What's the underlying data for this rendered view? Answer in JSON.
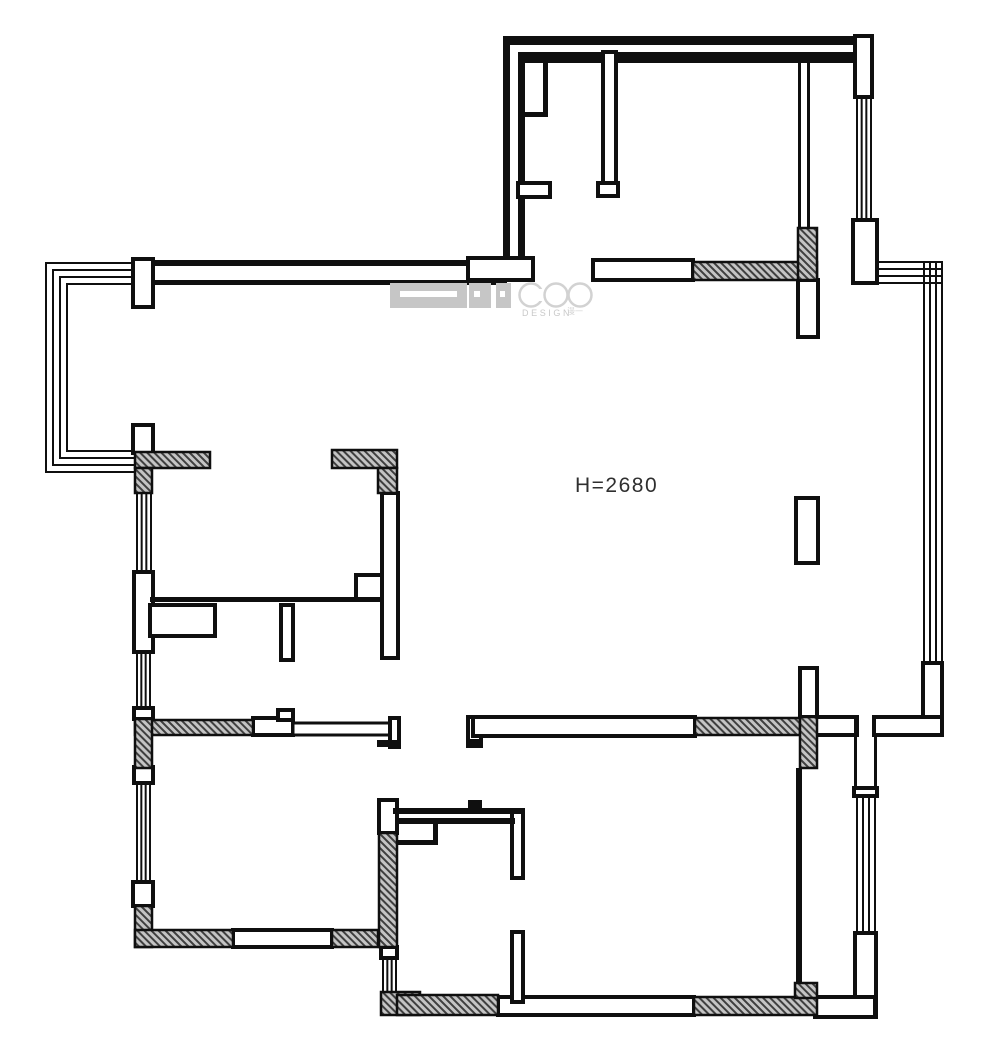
{
  "page": {
    "background": "#ffffff",
    "width": 1000,
    "height": 1056
  },
  "annotations": {
    "ceiling_height": "H=2680"
  },
  "logo": {
    "brand": "COO",
    "sub": "DESIGN",
    "seal": "漫一",
    "gray": "#c6c6c6",
    "light": "#d2d2d2"
  },
  "palette": {
    "ink": "#0f0f0f",
    "wall_fill": "#ffffff",
    "hatch_bg": "#c4c4c4",
    "hatch_line": "#3f3f3f",
    "label": "#2f2f2f"
  },
  "floorplan": {
    "width": 1000,
    "height": 1056,
    "elements": [
      {
        "t": "solid",
        "n": "top-wall-outer-line",
        "x": 135,
        "y": 260,
        "w": 372,
        "h": 6
      },
      {
        "t": "solid",
        "n": "top-wall-inner-line",
        "x": 150,
        "y": 280,
        "w": 357,
        "h": 5
      },
      {
        "t": "solid",
        "n": "north-room-top-wall",
        "x": 507,
        "y": 36,
        "w": 365,
        "h": 9
      },
      {
        "t": "solid",
        "n": "north-room-top-inner-line",
        "x": 518,
        "y": 52,
        "w": 339,
        "h": 11
      },
      {
        "t": "solid",
        "n": "north-room-left-wall-outer",
        "x": 503,
        "y": 36,
        "w": 7,
        "h": 227
      },
      {
        "t": "solid",
        "n": "north-room-left-wall-inner",
        "x": 518,
        "y": 52,
        "w": 7,
        "h": 218
      },
      {
        "t": "solid",
        "n": "duct-shaft-bottom-line",
        "x": 522,
        "y": 112,
        "w": 26,
        "h": 5
      },
      {
        "t": "solid",
        "n": "duct-shaft-right-line",
        "x": 543,
        "y": 63,
        "w": 5,
        "h": 54
      },
      {
        "t": "solid",
        "n": "north-room-divider-line-a",
        "x": 798,
        "y": 52,
        "w": 3,
        "h": 176
      },
      {
        "t": "solid",
        "n": "north-room-divider-line-b",
        "x": 807,
        "y": 52,
        "w": 3,
        "h": 176
      },
      {
        "t": "wall",
        "n": "bay-window-pier",
        "x": 133,
        "y": 259,
        "w": 20,
        "h": 48
      },
      {
        "t": "wall",
        "n": "north-room-door-jamb",
        "x": 468,
        "y": 258,
        "w": 65,
        "h": 22
      },
      {
        "t": "wall",
        "n": "north-room-closet-stub",
        "x": 518,
        "y": 183,
        "w": 32,
        "h": 14
      },
      {
        "t": "wall",
        "n": "north-room-partition",
        "x": 603,
        "y": 52,
        "w": 13,
        "h": 131
      },
      {
        "t": "wall",
        "n": "north-room-partition-foot",
        "x": 598,
        "y": 183,
        "w": 20,
        "h": 13
      },
      {
        "t": "wall",
        "n": "north-room-bottom-wall",
        "x": 593,
        "y": 260,
        "w": 100,
        "h": 20
      },
      {
        "t": "wall",
        "n": "north-room-right-wall-top",
        "x": 855,
        "y": 36,
        "w": 17,
        "h": 61
      },
      {
        "t": "wall",
        "n": "north-room-right-wall-bottom",
        "x": 853,
        "y": 220,
        "w": 24,
        "h": 63
      },
      {
        "t": "wall",
        "n": "east-wall-piece",
        "x": 923,
        "y": 663,
        "w": 19,
        "h": 72
      },
      {
        "t": "wall",
        "n": "corridor-wall-east-a",
        "x": 813,
        "y": 717,
        "w": 44,
        "h": 18
      },
      {
        "t": "wall",
        "n": "corridor-wall-east-b",
        "x": 874,
        "y": 717,
        "w": 68,
        "h": 18
      },
      {
        "t": "wall",
        "n": "balcony-door-cap",
        "x": 854,
        "y": 788,
        "w": 23,
        "h": 8
      },
      {
        "t": "wall",
        "n": "balcony-right-wall-lower",
        "x": 855,
        "y": 933,
        "w": 21,
        "h": 84
      },
      {
        "t": "wall",
        "n": "balcony-bottom-wall",
        "x": 815,
        "y": 997,
        "w": 60,
        "h": 20
      },
      {
        "t": "wall",
        "n": "living-divider-piece-1",
        "x": 798,
        "y": 280,
        "w": 20,
        "h": 57
      },
      {
        "t": "wall",
        "n": "living-divider-piece-2",
        "x": 796,
        "y": 498,
        "w": 22,
        "h": 65
      },
      {
        "t": "wall",
        "n": "living-divider-piece-3",
        "x": 800,
        "y": 668,
        "w": 17,
        "h": 49
      },
      {
        "t": "wall",
        "n": "corridor-wall-west-white",
        "x": 253,
        "y": 718,
        "w": 40,
        "h": 17
      },
      {
        "t": "wall",
        "n": "corridor-wall-west-bump",
        "x": 278,
        "y": 710,
        "w": 15,
        "h": 10
      },
      {
        "t": "wall",
        "n": "sliding-door-leaf",
        "x": 293,
        "y": 723,
        "w": 97,
        "h": 12,
        "sw": 3
      },
      {
        "t": "wall",
        "n": "west-door-jamb",
        "x": 390,
        "y": 718,
        "w": 9,
        "h": 29
      },
      {
        "t": "wall",
        "n": "east-door-jamb",
        "x": 468,
        "y": 717,
        "w": 13,
        "h": 29
      },
      {
        "t": "wall",
        "n": "corridor-wall-mid-band",
        "x": 473,
        "y": 717,
        "w": 222,
        "h": 19
      },
      {
        "t": "wall",
        "n": "bay-window-jamb-bottom",
        "x": 133,
        "y": 425,
        "w": 20,
        "h": 28
      },
      {
        "t": "wall",
        "n": "left-wall-piece",
        "x": 134,
        "y": 572,
        "w": 19,
        "h": 80
      },
      {
        "t": "wall",
        "n": "left-wall-cap-a",
        "x": 134,
        "y": 708,
        "w": 19,
        "h": 11
      },
      {
        "t": "wall",
        "n": "left-wall-cap-b",
        "x": 134,
        "y": 767,
        "w": 19,
        "h": 16
      },
      {
        "t": "wall",
        "n": "left-wall-cap-c",
        "x": 133,
        "y": 882,
        "w": 20,
        "h": 24
      },
      {
        "t": "wall",
        "n": "southwest-bottom-wall-white",
        "x": 233,
        "y": 930,
        "w": 99,
        "h": 17
      },
      {
        "t": "wall",
        "n": "bath-left-wall-top",
        "x": 379,
        "y": 800,
        "w": 18,
        "h": 33
      },
      {
        "t": "wall",
        "n": "bath-left-wall-cap",
        "x": 381,
        "y": 947,
        "w": 16,
        "h": 11
      },
      {
        "t": "wall",
        "n": "bedroom-bottom-wall-white",
        "x": 498,
        "y": 997,
        "w": 196,
        "h": 18
      },
      {
        "t": "wall",
        "n": "bath-right-wall-upper",
        "x": 512,
        "y": 810,
        "w": 11,
        "h": 68
      },
      {
        "t": "wall",
        "n": "bath-right-wall-lower",
        "x": 512,
        "y": 932,
        "w": 11,
        "h": 70
      },
      {
        "t": "wall",
        "n": "kitchen-right-wall",
        "x": 382,
        "y": 493,
        "w": 16,
        "h": 165
      },
      {
        "t": "wall",
        "n": "kitchen-corner-box",
        "x": 356,
        "y": 575,
        "w": 26,
        "h": 25
      },
      {
        "t": "wall",
        "n": "kitchen-counter-box",
        "x": 150,
        "y": 605,
        "w": 65,
        "h": 31
      },
      {
        "t": "wall",
        "n": "kitchen-stub",
        "x": 281,
        "y": 605,
        "w": 12,
        "h": 55
      },
      {
        "t": "solid",
        "n": "kitchen-bottom-wall-line",
        "x": 150,
        "y": 597,
        "w": 232,
        "h": 5
      },
      {
        "t": "solid",
        "n": "balcony-door-side-line-a",
        "x": 854,
        "y": 717,
        "w": 3,
        "h": 73
      },
      {
        "t": "solid",
        "n": "balcony-door-side-line-b",
        "x": 874,
        "y": 735,
        "w": 3,
        "h": 55
      },
      {
        "t": "solid",
        "n": "balcony-left-wall",
        "x": 796,
        "y": 768,
        "w": 6,
        "h": 215
      },
      {
        "t": "solid",
        "n": "west-jamb-foot",
        "x": 377,
        "y": 740,
        "w": 22,
        "h": 7
      },
      {
        "t": "solid",
        "n": "east-jamb-foot",
        "x": 468,
        "y": 739,
        "w": 14,
        "h": 7
      },
      {
        "t": "solid",
        "n": "bath-top-wall-outer",
        "x": 393,
        "y": 808,
        "w": 130,
        "h": 6
      },
      {
        "t": "solid",
        "n": "bath-top-wall-inner",
        "x": 398,
        "y": 818,
        "w": 117,
        "h": 6
      },
      {
        "t": "solid",
        "n": "bath-top-wall-bump",
        "x": 468,
        "y": 800,
        "w": 14,
        "h": 8
      },
      {
        "t": "solid",
        "n": "bath-niche-bottom-line",
        "x": 398,
        "y": 840,
        "w": 40,
        "h": 5
      },
      {
        "t": "solid",
        "n": "bath-niche-right-line",
        "x": 433,
        "y": 818,
        "w": 5,
        "h": 27
      },
      {
        "t": "hatch",
        "n": "north-room-bottom-hatch",
        "x": 693,
        "y": 262,
        "w": 124,
        "h": 18
      },
      {
        "t": "hatch",
        "n": "north-room-pier-hatch",
        "x": 798,
        "y": 228,
        "w": 19,
        "h": 52
      },
      {
        "t": "hatch",
        "n": "southwest-corner-hatch-h",
        "x": 135,
        "y": 452,
        "w": 75,
        "h": 16
      },
      {
        "t": "hatch",
        "n": "southwest-corner-hatch-v",
        "x": 135,
        "y": 468,
        "w": 17,
        "h": 25
      },
      {
        "t": "hatch",
        "n": "kitchen-corner-hatch-h",
        "x": 332,
        "y": 450,
        "w": 65,
        "h": 18
      },
      {
        "t": "hatch",
        "n": "kitchen-corner-hatch-v",
        "x": 378,
        "y": 468,
        "w": 19,
        "h": 25
      },
      {
        "t": "hatch",
        "n": "corridor-west-hatch",
        "x": 135,
        "y": 720,
        "w": 118,
        "h": 15
      },
      {
        "t": "hatch",
        "n": "left-wall-mid-hatch",
        "x": 135,
        "y": 719,
        "w": 17,
        "h": 49
      },
      {
        "t": "hatch",
        "n": "left-wall-bottom-hatch",
        "x": 135,
        "y": 906,
        "w": 17,
        "h": 41
      },
      {
        "t": "hatch",
        "n": "southwest-bottom-hatch-a",
        "x": 135,
        "y": 930,
        "w": 98,
        "h": 17
      },
      {
        "t": "hatch",
        "n": "southwest-bottom-hatch-b",
        "x": 332,
        "y": 930,
        "w": 46,
        "h": 17
      },
      {
        "t": "hatch",
        "n": "bath-left-wall-hatch",
        "x": 379,
        "y": 833,
        "w": 18,
        "h": 114
      },
      {
        "t": "hatch",
        "n": "bath-corner-hatch",
        "x": 381,
        "y": 992,
        "w": 39,
        "h": 23
      },
      {
        "t": "hatch",
        "n": "bath-bottom-hatch",
        "x": 397,
        "y": 995,
        "w": 101,
        "h": 20
      },
      {
        "t": "hatch",
        "n": "bedroom-bottom-hatch",
        "x": 694,
        "y": 997,
        "w": 123,
        "h": 18
      },
      {
        "t": "hatch",
        "n": "corridor-east-hatch",
        "x": 695,
        "y": 718,
        "w": 105,
        "h": 17
      },
      {
        "t": "hatch",
        "n": "corridor-pier-hatch",
        "x": 800,
        "y": 717,
        "w": 17,
        "h": 51
      },
      {
        "t": "hatch",
        "n": "balcony-corner-hatch",
        "x": 795,
        "y": 983,
        "w": 22,
        "h": 15
      },
      {
        "t": "winv",
        "n": "north-room-right-window",
        "x": 856,
        "y": 97,
        "w": 16,
        "h": 123
      },
      {
        "t": "winh",
        "n": "corner-window-horizontal",
        "x": 875,
        "y": 261,
        "w": 68,
        "h": 23
      },
      {
        "t": "winv",
        "n": "corner-window-vertical",
        "x": 923,
        "y": 261,
        "w": 20,
        "h": 402
      },
      {
        "t": "winv",
        "n": "balcony-window",
        "x": 856,
        "y": 796,
        "w": 20,
        "h": 137
      },
      {
        "t": "winv",
        "n": "left-window-1",
        "x": 136,
        "y": 493,
        "w": 16,
        "h": 79
      },
      {
        "t": "winv",
        "n": "left-window-2",
        "x": 136,
        "y": 652,
        "w": 15,
        "h": 57
      },
      {
        "t": "winv",
        "n": "left-window-3",
        "x": 136,
        "y": 783,
        "w": 15,
        "h": 99
      },
      {
        "t": "winv",
        "n": "bath-window",
        "x": 382,
        "y": 958,
        "w": 15,
        "h": 34
      },
      {
        "t": "solid",
        "n": "bay-window-top-line-1",
        "x": 45,
        "y": 262,
        "w": 90,
        "h": 2
      },
      {
        "t": "solid",
        "n": "bay-window-top-line-2",
        "x": 52,
        "y": 269,
        "w": 83,
        "h": 2
      },
      {
        "t": "solid",
        "n": "bay-window-top-line-3",
        "x": 59,
        "y": 276,
        "w": 76,
        "h": 2
      },
      {
        "t": "solid",
        "n": "bay-window-top-line-4",
        "x": 66,
        "y": 283,
        "w": 69,
        "h": 2
      },
      {
        "t": "solid",
        "n": "bay-window-left-line-1",
        "x": 45,
        "y": 262,
        "w": 2,
        "h": 211
      },
      {
        "t": "solid",
        "n": "bay-window-left-line-2",
        "x": 52,
        "y": 269,
        "w": 2,
        "h": 197
      },
      {
        "t": "solid",
        "n": "bay-window-left-line-3",
        "x": 59,
        "y": 276,
        "w": 2,
        "h": 183
      },
      {
        "t": "solid",
        "n": "bay-window-left-line-4",
        "x": 66,
        "y": 283,
        "w": 2,
        "h": 169
      },
      {
        "t": "solid",
        "n": "bay-window-bottom-line-1",
        "x": 45,
        "y": 471,
        "w": 90,
        "h": 2
      },
      {
        "t": "solid",
        "n": "bay-window-bottom-line-2",
        "x": 52,
        "y": 464,
        "w": 83,
        "h": 2
      },
      {
        "t": "solid",
        "n": "bay-window-bottom-line-3",
        "x": 59,
        "y": 457,
        "w": 76,
        "h": 2
      },
      {
        "t": "solid",
        "n": "bay-window-bottom-line-4",
        "x": 66,
        "y": 450,
        "w": 69,
        "h": 2
      },
      {
        "t": "grect",
        "n": "logo-block-large",
        "x": 390,
        "y": 283,
        "w": 77,
        "h": 25
      },
      {
        "t": "wrect",
        "n": "logo-block-large-slot",
        "x": 400,
        "y": 291,
        "w": 57,
        "h": 6
      },
      {
        "t": "grect",
        "n": "logo-block-mid",
        "x": 469,
        "y": 283,
        "w": 22,
        "h": 25
      },
      {
        "t": "wrect",
        "n": "logo-block-mid-slot",
        "x": 474,
        "y": 291,
        "w": 6,
        "h": 6
      },
      {
        "t": "grect",
        "n": "logo-block-small",
        "x": 496,
        "y": 283,
        "w": 15,
        "h": 25
      },
      {
        "t": "wrect",
        "n": "logo-block-small-slot",
        "x": 500,
        "y": 291,
        "w": 5,
        "h": 6
      },
      {
        "t": "circle",
        "n": "logo-letter-c",
        "cx": 531,
        "cy": 295,
        "r": 11.5
      },
      {
        "t": "wrect",
        "n": "logo-letter-c-gap",
        "x": 537,
        "y": 289,
        "w": 9,
        "h": 12
      },
      {
        "t": "circle",
        "n": "logo-letter-o1",
        "cx": 556,
        "cy": 295,
        "r": 11.5
      },
      {
        "t": "circle",
        "n": "logo-letter-o2",
        "cx": 580,
        "cy": 295,
        "r": 11.5
      }
    ]
  }
}
